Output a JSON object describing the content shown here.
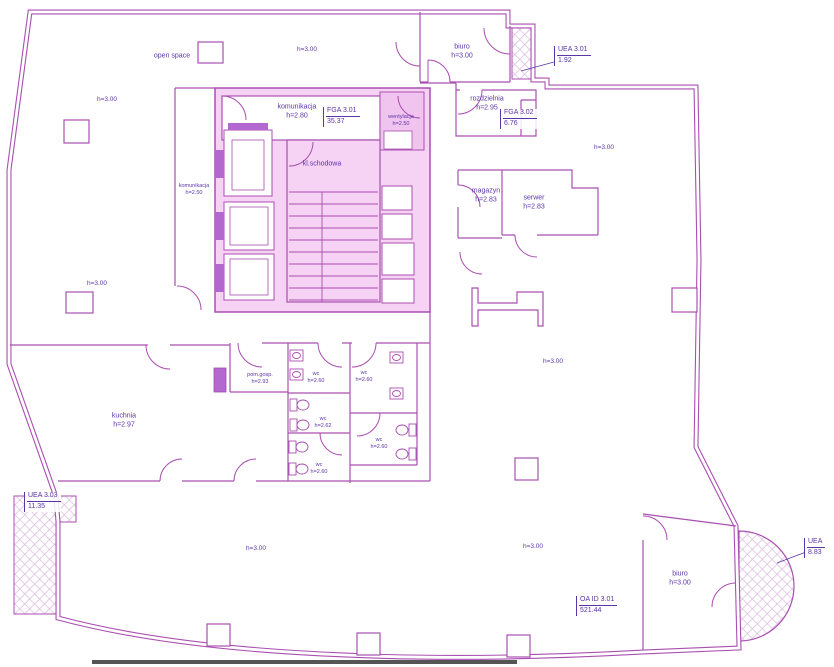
{
  "plan": {
    "rooms": {
      "open_space": {
        "name": "open space"
      },
      "biuro_top": {
        "name": "biuro",
        "height": "h=3.00"
      },
      "komunikacja_top": {
        "name": "komunikacja",
        "height": "h=2.80"
      },
      "wentylacja": {
        "name": "wentylacja",
        "height": "h=2.50"
      },
      "rozdzielnia": {
        "name": "rozdzielnia",
        "height": "h=2.95"
      },
      "magazyn": {
        "name": "magazyn",
        "height": "h=2.83"
      },
      "serwer": {
        "name": "serwer",
        "height": "h=2.83"
      },
      "komunikacja_left": {
        "name": "komunikacja",
        "height": "h=2.50"
      },
      "kl_schodowa": {
        "name": "kl.schodowa"
      },
      "kuchnia": {
        "name": "kuchnia",
        "height": "h=2.97"
      },
      "pom_gosp": {
        "name": "pom.gosp.",
        "height": "h=2.93"
      },
      "wc1": {
        "name": "wc",
        "height": "h=2.60"
      },
      "wc2": {
        "name": "wc",
        "height": "h=2.60"
      },
      "wc3": {
        "name": "wc",
        "height": "h=2.62"
      },
      "wc4": {
        "name": "wc",
        "height": "h=2.60"
      },
      "wc5": {
        "name": "wc",
        "height": "h=2.60"
      },
      "biuro_bottom": {
        "name": "biuro",
        "height": "h=3.00"
      }
    },
    "height_marks": {
      "h300": "h=3.00"
    },
    "area_labels": {
      "fga1": {
        "code": "FGA 3.01",
        "value": "35.37"
      },
      "fga2": {
        "code": "FGA 3.02",
        "value": "6.76"
      },
      "uea1": {
        "code": "UEA 3.01",
        "value": "1.92"
      },
      "uea2": {
        "code": "UEA",
        "value": "8.83"
      },
      "uea3": {
        "code": "UEA 3.03",
        "value": "11.35"
      },
      "oa": {
        "code": "OA ID 3.01",
        "value": "521.44"
      }
    },
    "colors": {
      "wall": "#a94fb0",
      "text": "#5b35a8",
      "core_fill": "#f6d2f4",
      "dark_fill": "#b268cf",
      "hatch": "#dcc0e0"
    }
  }
}
